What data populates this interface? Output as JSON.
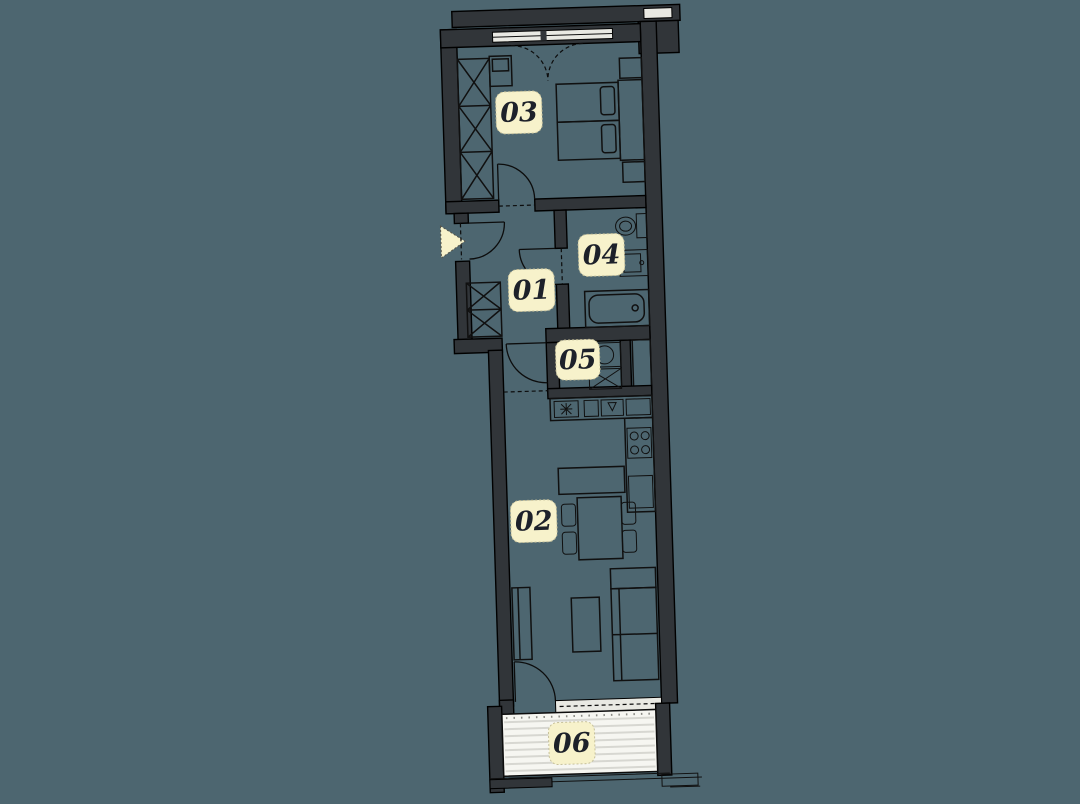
{
  "colors": {
    "background": "#4d6670",
    "wall": "#313539",
    "outline": "#0c0c0c",
    "balcony_floor": "#f6f6f1",
    "balcony_stripe": "#d7d7d1",
    "window_glass": "#e9e9e3",
    "label_background": "#f7f2cb",
    "label_text": "#1d212a",
    "entrance_arrow": "#f7f2cb"
  },
  "rooms": [
    {
      "number": "01",
      "name": "hallway"
    },
    {
      "number": "02",
      "name": "living-room-kitchen"
    },
    {
      "number": "03",
      "name": "bedroom"
    },
    {
      "number": "04",
      "name": "bathroom"
    },
    {
      "number": "05",
      "name": "utility"
    },
    {
      "number": "06",
      "name": "balcony"
    }
  ],
  "symbols": {
    "entrance": "entrance-arrow"
  }
}
